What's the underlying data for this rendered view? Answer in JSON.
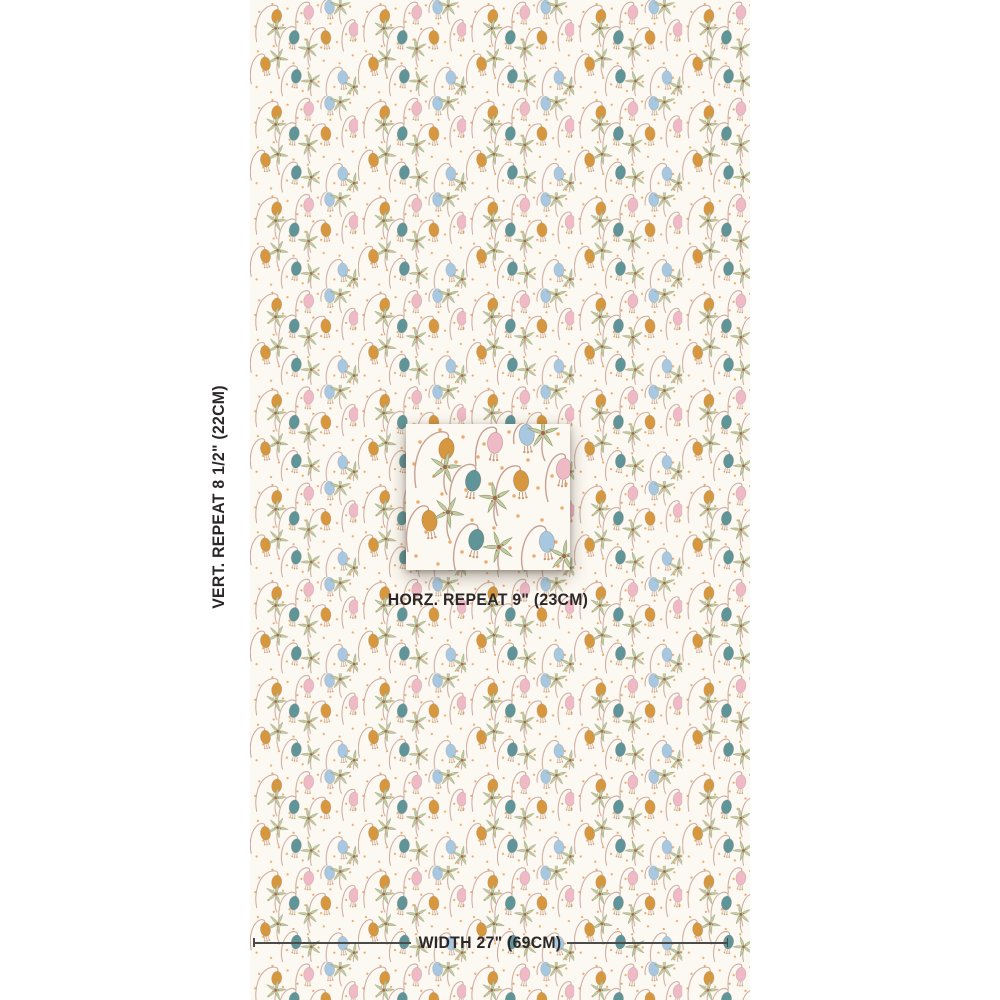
{
  "product": {
    "type": "fabric swatch visualization with repeat inset and dimensions",
    "page_background": "#ffffff",
    "swatch_background": "#fcf9f2"
  },
  "labels": {
    "vertical_repeat": "VERT. REPEAT 8 1/2\" (22CM)",
    "horizontal_repeat": "HORZ. REPEAT 9\" (23CM)",
    "width": "WIDTH 27\" (69CM)"
  },
  "pattern": {
    "description": "Drooping bell flowers on arching stems, star-shaped sage blossoms, scattered orange pin dots on cream ground",
    "colors": {
      "ochre_bell": "#d6973f",
      "teal_bell": "#5f9598",
      "pink_bell": "#efb9c6",
      "blue_bell": "#a8c8e2",
      "stem": "#c6a094",
      "star_petal": "#c3cb9f",
      "star_center": "#a5674c",
      "dot": "#eca96b"
    }
  },
  "annotation": {
    "line_color": "#4b4b4b",
    "text_color": "#2b2728"
  }
}
